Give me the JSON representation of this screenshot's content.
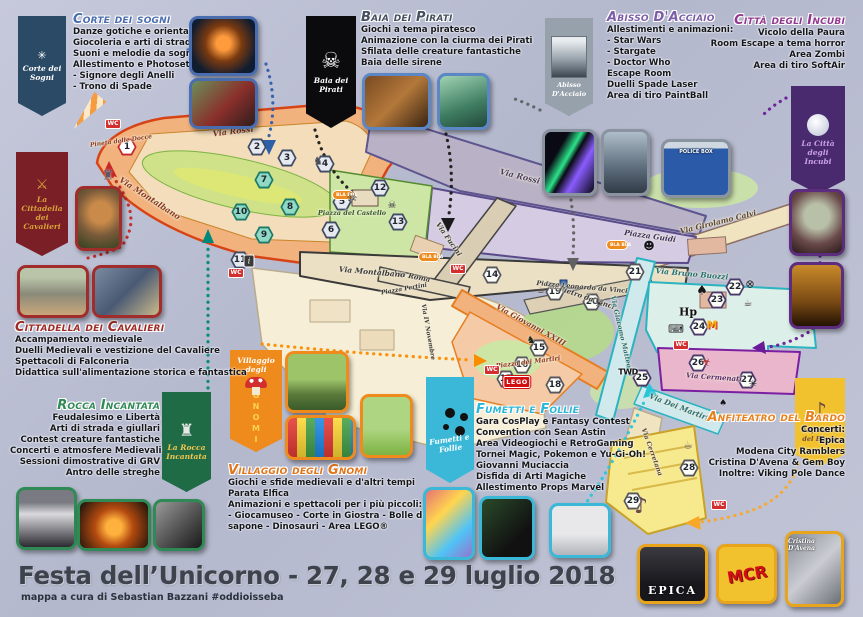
{
  "footer": {
    "title": "Festa dell’Unicorno - 27, 28 e 29 luglio 2018",
    "credit": "mappa a cura di Sebastian Bazzani #oddioisseba"
  },
  "sections": {
    "corte": {
      "title": "Corte dei sogni",
      "color": "#4a6db0",
      "lines": [
        "Danze gotiche e orientali",
        "Giocoleria e arti di strada",
        "Suoni e melodie da sogno",
        "Allestimento e Photoset:",
        "- Signore degli Anelli",
        "- Trono di Spade"
      ]
    },
    "baia": {
      "title": "Baia dei Pirati",
      "color": "#44505f",
      "lines": [
        "Giochi a tema piratesco",
        "Animazione con la ciurma dei Pirati",
        "Sfilata delle creature fantastiche",
        "Baia delle sirene"
      ]
    },
    "abisso": {
      "title": "Abisso D'Acciaio",
      "color": "#7b5ea7",
      "lines": [
        "Allestimenti e animazioni:",
        "- Star Wars",
        "- Stargate",
        "- Doctor Who",
        "Escape Room",
        "Duelli Spade Laser",
        "Area di tiro PaintBall"
      ]
    },
    "incubi": {
      "title": "Città degli Incubi",
      "color": "#93388f",
      "lines": [
        "Vicolo della Paura",
        "Room Escape a tema horror",
        "Area Zombi",
        "Area di tiro SoftAir"
      ]
    },
    "cavalieri": {
      "title": "Cittadella dei Cavalieri",
      "color": "#9e2b25",
      "lines": [
        "Accampamento medievale",
        "Duelli Medievali e vestizione del Cavaliere",
        "Spettacoli di Falconeria",
        "Didattica sull'alimentazione storica e fantastica"
      ]
    },
    "rocca": {
      "title": "Rocca Incantata",
      "color": "#2f8a55",
      "lines": [
        "Feudalesimo e Libertà",
        "Arti di strada e giullari",
        "Contest creature fantastiche",
        "Concerti e atmosfere Medievali",
        "Sessioni dimostrative di GRV",
        "Antro delle streghe"
      ]
    },
    "gnomi": {
      "title": "Villaggio degli Gnomi",
      "color": "#e0751a",
      "lines": [
        "Giochi e sfide medievali e d'altri tempi",
        "Parata Elfica",
        "Animazioni e spettacoli per i più piccoli:",
        "- Giocamuseo - Corte in Giostra - Bolle di",
        "sapone - Dinosauri - Area LEGO®"
      ]
    },
    "fumetti": {
      "title": "Fumetti e Follie",
      "color": "#29b6d8",
      "lines": [
        "Gara CosPlay e Fantasy Contest",
        "Convention con Sean Astin",
        "Area Videogiochi e RetroGaming",
        "Tornei Magic, Pokemon e Yu-Gi-Oh!",
        "Giovanni Muciaccia",
        "Disfida di Arti Magiche",
        "Allestimento Props Marvel"
      ]
    },
    "bardo": {
      "title": "Anfiteatro del Bardo",
      "color": "#e8821e",
      "lines": [
        "Concerti:",
        "Epica",
        "Modena City Ramblers",
        "Cristina D'Avena & Gem Boy",
        "Inoltre: Viking Pole Dance"
      ]
    }
  },
  "banners": {
    "corte": {
      "label": "Corte dei Sogni"
    },
    "baia": {
      "label": "Baia dei Pirati"
    },
    "abisso": {
      "label": "Abisso D'Acciaio"
    },
    "incubi": {
      "label": "La Città degli Incubi"
    },
    "cavalieri": {
      "label": "La Cittadella dei Cavalieri"
    },
    "rocca": {
      "label": "La Rocca Incantata"
    },
    "gnomi": {
      "label_top": "Villaggio degli",
      "label_vert": "GNOMI"
    },
    "fumetti": {
      "label": "Fumetti e Follie"
    },
    "bardo": {
      "label": "Anfiteatro del Bardo"
    }
  },
  "photo_labels": {
    "police": "POLICE BOX",
    "epica": "EPICA",
    "mcr": "MCR",
    "cristina": "Cristina D'Avena"
  },
  "map": {
    "roads": [
      {
        "t": "Via Rossi",
        "x": 233,
        "y": 131,
        "r": -7,
        "c": "#8d3a1f",
        "s": 8
      },
      {
        "t": "Via Montalbano",
        "x": 150,
        "y": 198,
        "r": 33,
        "c": "#8d3a1f",
        "s": 8
      },
      {
        "t": "Via Rossi",
        "x": 520,
        "y": 176,
        "r": 14,
        "c": "#4a3f66",
        "s": 8
      },
      {
        "t": "Via Fucini",
        "x": 449,
        "y": 239,
        "r": 55,
        "c": "#3a3a3a",
        "s": 7
      },
      {
        "t": "Via Roma",
        "x": 412,
        "y": 276,
        "r": 11,
        "c": "#3a3a3a",
        "s": 7
      },
      {
        "t": "Via Montalbano",
        "x": 372,
        "y": 272,
        "r": 5,
        "c": "#3a3a3a",
        "s": 7.5
      },
      {
        "t": "Via Giovanni XXIII",
        "x": 531,
        "y": 325,
        "r": 29,
        "c": "#8d3a1f",
        "s": 7.5
      },
      {
        "t": "Via Pietro da Vinci",
        "x": 580,
        "y": 295,
        "r": 19,
        "c": "#3a3a3a",
        "s": 7
      },
      {
        "t": "Via Giacomo Matteotti",
        "x": 622,
        "y": 336,
        "r": 77,
        "c": "#1f6f7a",
        "s": 6.5
      },
      {
        "t": "Via Girolamo Calvi",
        "x": 718,
        "y": 222,
        "r": -14,
        "c": "#5a4632",
        "s": 7.5
      },
      {
        "t": "Via Bruno Buozzi",
        "x": 692,
        "y": 274,
        "r": 5,
        "c": "#1f6f7a",
        "s": 7.5
      },
      {
        "t": "Via Cermenati",
        "x": 714,
        "y": 377,
        "r": 4,
        "c": "#5a2a6e",
        "s": 7
      },
      {
        "t": "Via Dei Martiri",
        "x": 679,
        "y": 407,
        "r": 21,
        "c": "#1f6f7a",
        "s": 7.5
      },
      {
        "t": "Via Cerretana",
        "x": 652,
        "y": 452,
        "r": 70,
        "c": "#5a4632",
        "s": 6.5
      },
      {
        "t": "Via IV Novembre",
        "x": 428,
        "y": 332,
        "r": 80,
        "c": "#3a3a3a",
        "s": 6
      },
      {
        "t": "Piazza del Castello",
        "x": 352,
        "y": 213,
        "r": 0,
        "c": "#2f5a2a",
        "s": 6.5
      },
      {
        "t": "Piazza Guidi",
        "x": 650,
        "y": 236,
        "r": 8,
        "c": "#3a3066",
        "s": 7.5
      },
      {
        "t": "Piazza Leonardo da Vinci",
        "x": 582,
        "y": 287,
        "r": 5,
        "c": "#3a3a3a",
        "s": 6.5
      },
      {
        "t": "Piazza dei Martiri",
        "x": 528,
        "y": 362,
        "r": -7,
        "c": "#8d3a1f",
        "s": 6.5
      },
      {
        "t": "Piazza Pertini",
        "x": 404,
        "y": 289,
        "r": -10,
        "c": "#3a3a3a",
        "s": 6
      },
      {
        "t": "Pineta delle Docce",
        "x": 121,
        "y": 141,
        "r": -8,
        "c": "#8d3a1f",
        "s": 6
      }
    ],
    "markers": [
      {
        "n": 1,
        "x": 127,
        "y": 147,
        "v": "red"
      },
      {
        "n": 2,
        "x": 257,
        "y": 147,
        "v": "slate"
      },
      {
        "n": 3,
        "x": 287,
        "y": 158,
        "v": "slate"
      },
      {
        "n": 4,
        "x": 325,
        "y": 164,
        "v": "slate"
      },
      {
        "n": 5,
        "x": 342,
        "y": 202,
        "v": "slate"
      },
      {
        "n": 6,
        "x": 331,
        "y": 230,
        "v": "slate"
      },
      {
        "n": 7,
        "x": 264,
        "y": 180,
        "v": "green"
      },
      {
        "n": 8,
        "x": 290,
        "y": 207,
        "v": "green"
      },
      {
        "n": 9,
        "x": 264,
        "y": 235,
        "v": "green"
      },
      {
        "n": 10,
        "x": 241,
        "y": 212,
        "v": "green"
      },
      {
        "n": 11,
        "x": 240,
        "y": 260,
        "v": "slate"
      },
      {
        "n": 12,
        "x": 380,
        "y": 188,
        "v": "slate"
      },
      {
        "n": 13,
        "x": 398,
        "y": 222,
        "v": "slate"
      },
      {
        "n": 14,
        "x": 492,
        "y": 275,
        "v": "white"
      },
      {
        "n": 15,
        "x": 539,
        "y": 348,
        "v": "white"
      },
      {
        "n": 16,
        "x": 522,
        "y": 365,
        "v": "white"
      },
      {
        "n": 17,
        "x": 506,
        "y": 379,
        "v": "white"
      },
      {
        "n": 18,
        "x": 555,
        "y": 385,
        "v": "white"
      },
      {
        "n": 19,
        "x": 555,
        "y": 292,
        "v": "white"
      },
      {
        "n": 20,
        "x": 592,
        "y": 302,
        "v": "white"
      },
      {
        "n": 21,
        "x": 635,
        "y": 272,
        "v": "white"
      },
      {
        "n": 22,
        "x": 735,
        "y": 287,
        "v": "purple"
      },
      {
        "n": 23,
        "x": 717,
        "y": 300,
        "v": "purple"
      },
      {
        "n": 24,
        "x": 699,
        "y": 327,
        "v": "purple"
      },
      {
        "n": 25,
        "x": 642,
        "y": 378,
        "v": "purple"
      },
      {
        "n": 26,
        "x": 698,
        "y": 363,
        "v": "purple"
      },
      {
        "n": 27,
        "x": 747,
        "y": 380,
        "v": "purple"
      },
      {
        "n": 28,
        "x": 689,
        "y": 468,
        "v": "white"
      },
      {
        "n": 29,
        "x": 633,
        "y": 501,
        "v": "white"
      }
    ],
    "badges": [
      {
        "t": "WC",
        "cls": "wc",
        "x": 113,
        "y": 124,
        "n": "wc-badge"
      },
      {
        "t": "WC",
        "cls": "wc",
        "x": 236,
        "y": 273,
        "n": "wc-badge"
      },
      {
        "t": "WC",
        "cls": "wc",
        "x": 458,
        "y": 269,
        "n": "wc-badge"
      },
      {
        "t": "WC",
        "cls": "wc",
        "x": 492,
        "y": 370,
        "n": "wc-badge"
      },
      {
        "t": "WC",
        "cls": "wc",
        "x": 681,
        "y": 345,
        "n": "wc-badge"
      },
      {
        "t": "WC",
        "cls": "wc",
        "x": 719,
        "y": 505,
        "n": "wc-badge"
      },
      {
        "t": "i",
        "cls": "info",
        "x": 249,
        "y": 261,
        "n": "info-badge"
      },
      {
        "t": "BLA BLA",
        "cls": "bla",
        "x": 343,
        "y": 195,
        "n": "bla-bla-badge"
      },
      {
        "t": "BLA BLA",
        "cls": "bla",
        "x": 429,
        "y": 257,
        "n": "bla-bla-badge"
      },
      {
        "t": "BLA BLA",
        "cls": "bla",
        "x": 617,
        "y": 245,
        "n": "bla-bla-badge"
      },
      {
        "t": "TWD",
        "cls": "twd",
        "x": 628,
        "y": 372,
        "n": "twd-label"
      },
      {
        "t": "Hp",
        "cls": "hp",
        "x": 688,
        "y": 312,
        "n": "hp-label"
      },
      {
        "t": "M",
        "cls": "mm",
        "x": 712,
        "y": 325,
        "n": "m-label"
      },
      {
        "t": "LEGO",
        "cls": "lego",
        "x": 517,
        "y": 382,
        "n": "lego-logo"
      }
    ],
    "icons": [
      {
        "g": "☠",
        "x": 352,
        "y": 197,
        "s": 12,
        "c": "#15151a",
        "n": "skull-icon"
      },
      {
        "g": "☠",
        "x": 392,
        "y": 206,
        "s": 10,
        "c": "#15151a",
        "n": "skull-icon"
      },
      {
        "g": "♜",
        "x": 108,
        "y": 176,
        "s": 13,
        "c": "#5a5a66",
        "n": "castle-icon"
      },
      {
        "g": "♞",
        "x": 318,
        "y": 161,
        "s": 11,
        "c": "#4a4a52",
        "n": "knight-icon"
      },
      {
        "g": "♞",
        "x": 531,
        "y": 341,
        "s": 10,
        "c": "#1a2a1a",
        "n": "dinosaur-icon"
      },
      {
        "g": "☻",
        "x": 649,
        "y": 246,
        "s": 11,
        "c": "#15151a",
        "n": "vader-icon"
      },
      {
        "g": "♠",
        "x": 702,
        "y": 291,
        "s": 13,
        "c": "#15151a",
        "n": "bat-icon"
      },
      {
        "g": "♠",
        "x": 723,
        "y": 404,
        "s": 9,
        "c": "#15151a",
        "n": "bat-icon"
      },
      {
        "g": "⌨",
        "x": 676,
        "y": 329,
        "s": 11,
        "c": "#15151a",
        "n": "gamepad-icon"
      },
      {
        "g": "☣",
        "x": 706,
        "y": 362,
        "s": 11,
        "c": "#b71c1c",
        "n": "biohazard-icon"
      },
      {
        "g": "✳",
        "x": 599,
        "y": 305,
        "s": 10,
        "c": "#15151a",
        "n": "spiderweb-icon"
      },
      {
        "g": "✳",
        "x": 753,
        "y": 385,
        "s": 10,
        "c": "#15151a",
        "n": "spiderweb-icon"
      },
      {
        "g": "⊗",
        "x": 750,
        "y": 284,
        "s": 11,
        "c": "#15151a",
        "n": "food-icon"
      },
      {
        "g": "☕",
        "x": 541,
        "y": 291,
        "s": 10,
        "c": "#3e2f23",
        "n": "beer-icon"
      },
      {
        "g": "☕",
        "x": 748,
        "y": 304,
        "s": 10,
        "c": "#3e2f23",
        "n": "beer-icon"
      },
      {
        "g": "☕",
        "x": 688,
        "y": 445,
        "s": 11,
        "c": "#6a5a3a",
        "n": "beer-icon"
      },
      {
        "g": "♪",
        "x": 641,
        "y": 507,
        "s": 22,
        "c": "#6d4c41",
        "n": "treble-clef-icon"
      }
    ]
  }
}
